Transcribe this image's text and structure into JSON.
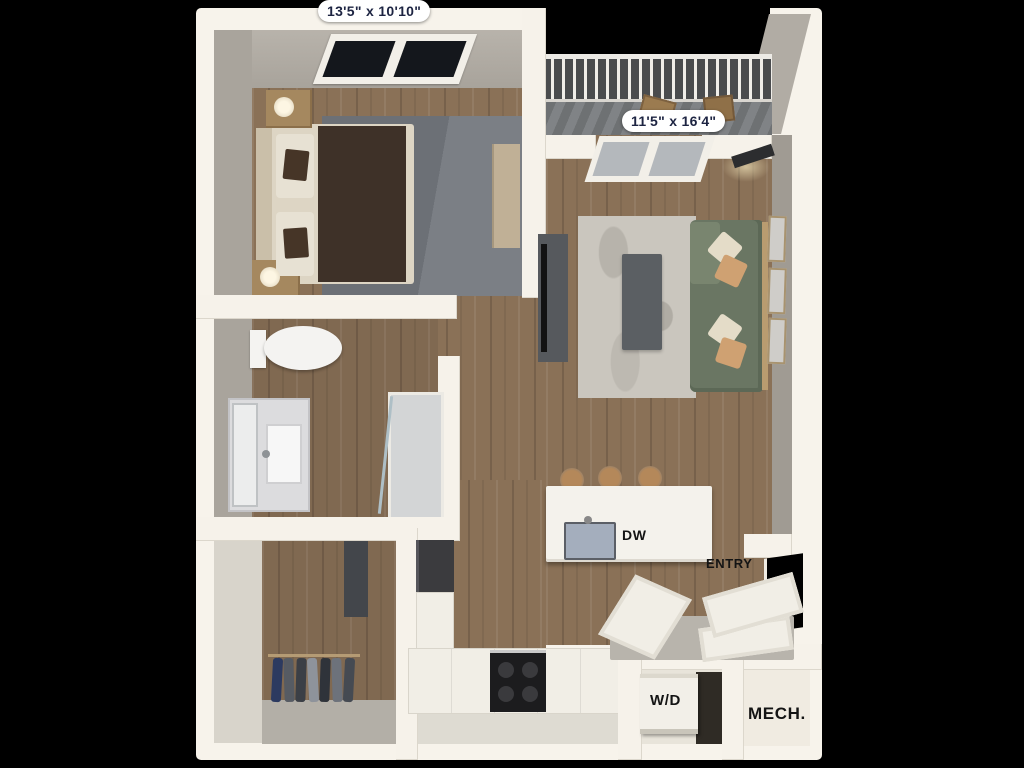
{
  "labels": {
    "bedroom_dimensions": "13'5\" x 10'10\"",
    "living_dimensions": "11'5\" x 16'4\"",
    "dishwasher": "DW",
    "entry": "ENTRY",
    "washer_dryer": "W/D",
    "mechanical": "MECH."
  },
  "colors": {
    "background": "#000000",
    "outer_wall": "#f7f3eb",
    "inner_wall_face": "#a9a49c",
    "wood_floor": "#8a7157",
    "bedroom_rug": "#70747a",
    "living_rug": "#cac6be",
    "sofa_green": "#6a7663",
    "duvet_brown": "#3e3128",
    "balcony_deck": "#75787b",
    "dimension_text": "#1d2442",
    "annotation_text": "#141414"
  }
}
